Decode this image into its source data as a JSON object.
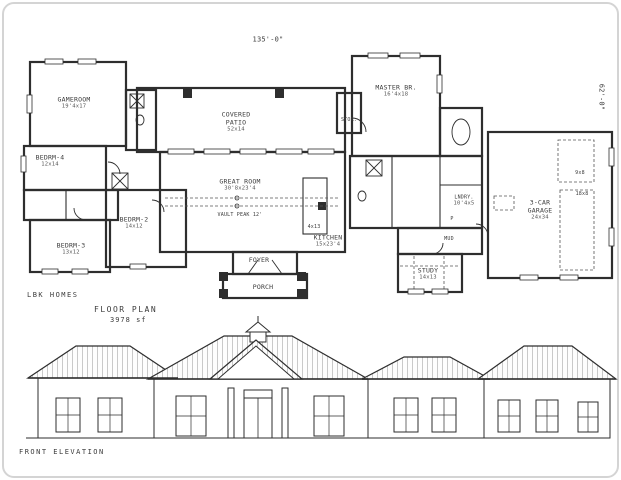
{
  "titleblock": {
    "firm": "LBK HOMES",
    "plan_label": "FLOOR PLAN",
    "plan_area": "3978 sf",
    "elevation_label": "FRONT ELEVATION"
  },
  "dimensions": {
    "overall_width": "135'-0\"",
    "overall_depth": "62'-0\""
  },
  "colors": {
    "ink": "#2e2e2e",
    "paper": "#ffffff",
    "frame_border": "#d4d4d4"
  },
  "rooms": {
    "gameroom": {
      "name": "GAMEROOM",
      "dim": "19'4x17"
    },
    "bedrm4": {
      "name": "BEDRM-4",
      "dim": "12x14"
    },
    "bedrm3": {
      "name": "BEDRM-3",
      "dim": "13x12"
    },
    "bedrm2": {
      "name": "BEDRM-2",
      "dim": "14x12"
    },
    "covered_patio": {
      "name": "COVERED PATIO",
      "dim": "52x14"
    },
    "great_room": {
      "name": "GREAT ROOM",
      "dim": "30'8x23'4",
      "note": "VAULT PEAK 12'"
    },
    "kitchen": {
      "name": "KITCHEN",
      "dim": "15x23'4"
    },
    "island": {
      "dim": "4x13"
    },
    "stor": {
      "name": "STOR."
    },
    "foyer": {
      "name": "FOYER"
    },
    "porch": {
      "name": "PORCH"
    },
    "master": {
      "name": "MASTER BR.",
      "dim": "16'4x18"
    },
    "lndry": {
      "name": "LNDRY.",
      "dim": "10'4x5"
    },
    "pantry": {
      "name": "P"
    },
    "mud": {
      "name": "MUD"
    },
    "study": {
      "name": "STUDY",
      "dim": "14x13"
    },
    "garage": {
      "name": "3-CAR GARAGE",
      "dim": "24x34"
    },
    "garage_door_single": {
      "dim": "9x8"
    },
    "garage_door_double": {
      "dim": "18x8"
    }
  }
}
